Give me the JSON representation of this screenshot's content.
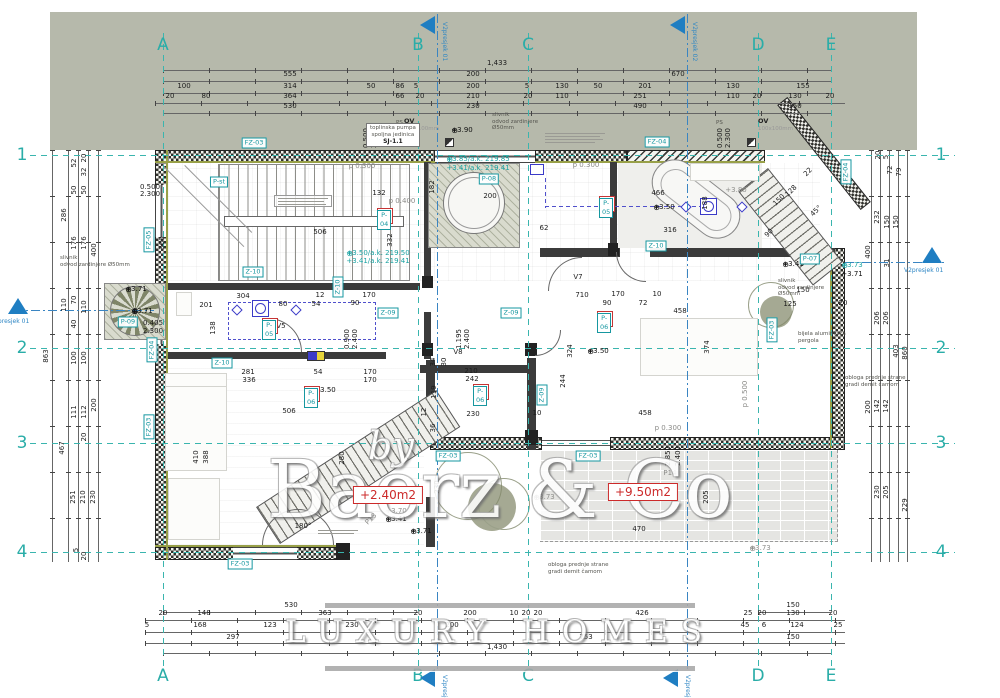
{
  "watermark": {
    "by": "by",
    "name": "Baerz & Co",
    "tagline": "LUXURY HOMES"
  },
  "grid": {
    "cols": [
      {
        "l": "A",
        "x": 163
      },
      {
        "l": "B",
        "x": 418
      },
      {
        "l": "C",
        "x": 528
      },
      {
        "l": "D",
        "x": 758
      },
      {
        "l": "E",
        "x": 831
      }
    ],
    "rows": [
      {
        "l": "1",
        "y": 155
      },
      {
        "l": "2",
        "y": 348
      },
      {
        "l": "3",
        "y": 443
      },
      {
        "l": "4",
        "y": 552
      }
    ]
  },
  "sections": [
    {
      "t": "V2presjek 01",
      "kind": "top",
      "x": 437,
      "y": 16
    },
    {
      "t": "V2presjek 02",
      "kind": "top",
      "x": 687,
      "y": 16
    },
    {
      "t": "V2presjek 01",
      "kind": "bottom",
      "x": 437,
      "y": 669
    },
    {
      "t": "V2presjek 02",
      "kind": "bottom",
      "x": 680,
      "y": 669
    },
    {
      "t": "V2presjek 01",
      "kind": "left",
      "x": 18,
      "y": 298
    },
    {
      "t": "V2presjek 01",
      "kind": "right",
      "x": 932,
      "y": 247
    }
  ],
  "rooms": [
    {
      "n": "1",
      "tag": "P-04",
      "x": 377,
      "y": 208
    },
    {
      "n": "4",
      "tag": "P-05",
      "x": 599,
      "y": 196
    },
    {
      "n": "2",
      "tag": "P-06",
      "x": 597,
      "y": 311
    },
    {
      "n": "3",
      "tag": "P-06",
      "x": 473,
      "y": 384
    },
    {
      "n": "5",
      "tag": "P-06",
      "x": 304,
      "y": 386
    },
    {
      "n": "6",
      "tag": "P-05",
      "x": 262,
      "y": 318
    }
  ],
  "tags": [
    {
      "t": "FZ-03",
      "x": 254,
      "y": 143,
      "o": "h"
    },
    {
      "t": "FZ-04",
      "x": 657,
      "y": 142,
      "o": "h"
    },
    {
      "t": "FZ-04",
      "x": 846,
      "y": 172,
      "o": "v"
    },
    {
      "t": "FZ-05",
      "x": 149,
      "y": 240,
      "o": "v"
    },
    {
      "t": "FZ-04",
      "x": 152,
      "y": 350,
      "o": "v"
    },
    {
      "t": "FZ-03",
      "x": 149,
      "y": 427,
      "o": "v"
    },
    {
      "t": "FZ-03",
      "x": 240,
      "y": 564,
      "o": "h"
    },
    {
      "t": "FZ-03",
      "x": 448,
      "y": 456,
      "o": "h"
    },
    {
      "t": "FZ-03",
      "x": 588,
      "y": 456,
      "o": "h"
    },
    {
      "t": "FZ-03",
      "x": 772,
      "y": 330,
      "o": "v"
    },
    {
      "t": "Z-10",
      "x": 253,
      "y": 272,
      "o": "h"
    },
    {
      "t": "Z-10",
      "x": 656,
      "y": 246,
      "o": "h"
    },
    {
      "t": "Z-10",
      "x": 222,
      "y": 363,
      "o": "h"
    },
    {
      "t": "Z-10",
      "x": 338,
      "y": 287,
      "o": "v"
    },
    {
      "t": "Z-09",
      "x": 388,
      "y": 313,
      "o": "h"
    },
    {
      "t": "Z-09",
      "x": 511,
      "y": 313,
      "o": "h"
    },
    {
      "t": "Z-09",
      "x": 542,
      "y": 395,
      "o": "v"
    },
    {
      "t": "P-st",
      "x": 219,
      "y": 182,
      "o": "h"
    },
    {
      "t": "P-08",
      "x": 489,
      "y": 179,
      "o": "h"
    },
    {
      "t": "P-09",
      "x": 128,
      "y": 322,
      "o": "h"
    },
    {
      "t": "P-07",
      "x": 810,
      "y": 259,
      "o": "h"
    }
  ],
  "red_areas": [
    {
      "t": "+2.40m2",
      "x": 388,
      "y": 495
    },
    {
      "t": "+9.50m2",
      "x": 643,
      "y": 492
    }
  ],
  "levels": [
    {
      "t": "+3.90",
      "x": 462,
      "y": 130,
      "s": "b",
      "star": 1
    },
    {
      "t": "+3.50",
      "x": 664,
      "y": 207,
      "s": "b",
      "star": 1
    },
    {
      "t": "+3.50",
      "x": 598,
      "y": 351,
      "s": "b",
      "star": 1
    },
    {
      "t": "+3.50",
      "x": 325,
      "y": 390,
      "s": "b",
      "star": 1
    },
    {
      "t": "+3.41",
      "x": 793,
      "y": 264,
      "s": "b",
      "star": 1
    },
    {
      "t": "+3.73",
      "x": 852,
      "y": 265,
      "s": "t",
      "star": 1
    },
    {
      "t": "+3.71",
      "x": 852,
      "y": 274,
      "s": "b",
      "star": 0
    },
    {
      "t": "+3.71",
      "x": 136,
      "y": 289,
      "s": "b",
      "star": 1
    },
    {
      "t": "+3.71",
      "x": 142,
      "y": 311,
      "s": "b",
      "star": 1
    },
    {
      "t": "+3.85/a.k. 219.85",
      "x": 478,
      "y": 159,
      "s": "t",
      "star": 1
    },
    {
      "t": "+3.41/a.k. 219.41",
      "x": 478,
      "y": 168,
      "s": "t",
      "star": 0
    },
    {
      "t": "+3.50/a.k. 219.50",
      "x": 378,
      "y": 253,
      "s": "t",
      "star": 1
    },
    {
      "t": "+3.41/a.k. 219.41",
      "x": 378,
      "y": 261,
      "s": "t",
      "star": 0
    },
    {
      "t": "+3.80",
      "x": 736,
      "y": 190,
      "s": "g",
      "star": 0
    },
    {
      "t": "+3.73",
      "x": 544,
      "y": 497,
      "s": "g",
      "star": 1
    },
    {
      "t": "+3.70",
      "x": 396,
      "y": 511,
      "s": "g",
      "star": 0
    },
    {
      "t": "+3.41",
      "x": 396,
      "y": 519,
      "s": "b",
      "star": 1
    },
    {
      "t": "+3.71",
      "x": 421,
      "y": 531,
      "s": "b",
      "star": 1
    },
    {
      "t": "+3.73",
      "x": 760,
      "y": 548,
      "s": "g",
      "star": 1
    }
  ],
  "notes": [
    {
      "lines": [
        "slivnik",
        "odvod zardinjere",
        "Ø50mm"
      ],
      "x": 492,
      "y": 112
    },
    {
      "lines": [
        "slivnik",
        "odvod zardinjere Ø50mm"
      ],
      "x": 60,
      "y": 255
    },
    {
      "lines": [
        "slivnik",
        "odvod zardinjere",
        "Ø50mm"
      ],
      "x": 778,
      "y": 278
    },
    {
      "lines": [
        "OV",
        "100x100mm"
      ],
      "x": 404,
      "y": 118,
      "cls": "ov"
    },
    {
      "lines": [
        "OV",
        "100x100mm"
      ],
      "x": 758,
      "y": 118,
      "cls": "ov"
    },
    {
      "lines": [
        "PS"
      ],
      "x": 396,
      "y": 120
    },
    {
      "lines": [
        "PS"
      ],
      "x": 716,
      "y": 120
    },
    {
      "lines": [
        "bijela aluminijska",
        "pergola"
      ],
      "x": 798,
      "y": 331
    },
    {
      "lines": [
        "obloga prednje strane",
        "gradi demit čamom"
      ],
      "x": 845,
      "y": 375
    },
    {
      "lines": [
        "obloga prednje strane",
        "gradi demit čamom"
      ],
      "x": 548,
      "y": 562
    },
    {
      "lines": [
        "toplinska pumpa",
        "spoljna jedinica"
      ],
      "title": "SJ-1.1",
      "x": 366,
      "y": 123,
      "cls": "box"
    }
  ],
  "dims": [
    {
      "t": "1,433",
      "x": 497,
      "y": 63
    },
    {
      "t": "555",
      "x": 290,
      "y": 74
    },
    {
      "t": "200",
      "x": 473,
      "y": 74
    },
    {
      "t": "670",
      "x": 678,
      "y": 74
    },
    {
      "t": "100",
      "x": 184,
      "y": 86
    },
    {
      "t": "314",
      "x": 290,
      "y": 86
    },
    {
      "t": "50",
      "x": 371,
      "y": 86
    },
    {
      "t": "86",
      "x": 400,
      "y": 86
    },
    {
      "t": "5",
      "x": 416,
      "y": 86
    },
    {
      "t": "200",
      "x": 473,
      "y": 86
    },
    {
      "t": "5",
      "x": 527,
      "y": 86
    },
    {
      "t": "130",
      "x": 562,
      "y": 86
    },
    {
      "t": "50",
      "x": 598,
      "y": 86
    },
    {
      "t": "201",
      "x": 645,
      "y": 86
    },
    {
      "t": "130",
      "x": 733,
      "y": 86
    },
    {
      "t": "155",
      "x": 803,
      "y": 86
    },
    {
      "t": "20",
      "x": 170,
      "y": 96
    },
    {
      "t": "80",
      "x": 206,
      "y": 96
    },
    {
      "t": "364",
      "x": 290,
      "y": 96
    },
    {
      "t": "66",
      "x": 400,
      "y": 96
    },
    {
      "t": "20",
      "x": 420,
      "y": 96
    },
    {
      "t": "210",
      "x": 473,
      "y": 96
    },
    {
      "t": "20",
      "x": 528,
      "y": 96
    },
    {
      "t": "110",
      "x": 562,
      "y": 96
    },
    {
      "t": "251",
      "x": 640,
      "y": 96
    },
    {
      "t": "110",
      "x": 733,
      "y": 96
    },
    {
      "t": "20",
      "x": 757,
      "y": 96
    },
    {
      "t": "130",
      "x": 795,
      "y": 96
    },
    {
      "t": "20",
      "x": 830,
      "y": 96
    },
    {
      "t": "530",
      "x": 290,
      "y": 106
    },
    {
      "t": "230",
      "x": 473,
      "y": 106
    },
    {
      "t": "490",
      "x": 640,
      "y": 106
    },
    {
      "t": "150",
      "x": 795,
      "y": 106
    },
    {
      "t": "530",
      "x": 291,
      "y": 605
    },
    {
      "t": "150",
      "x": 793,
      "y": 605
    },
    {
      "t": "20",
      "x": 163,
      "y": 613
    },
    {
      "t": "148",
      "x": 204,
      "y": 613
    },
    {
      "t": "363",
      "x": 325,
      "y": 613
    },
    {
      "t": "20",
      "x": 418,
      "y": 613
    },
    {
      "t": "200",
      "x": 470,
      "y": 613
    },
    {
      "t": "10",
      "x": 514,
      "y": 613
    },
    {
      "t": "20",
      "x": 526,
      "y": 613
    },
    {
      "t": "20",
      "x": 538,
      "y": 613
    },
    {
      "t": "426",
      "x": 642,
      "y": 613
    },
    {
      "t": "25",
      "x": 748,
      "y": 613
    },
    {
      "t": "20",
      "x": 762,
      "y": 613
    },
    {
      "t": "130",
      "x": 793,
      "y": 613
    },
    {
      "t": "20",
      "x": 833,
      "y": 613
    },
    {
      "t": "5",
      "x": 147,
      "y": 625
    },
    {
      "t": "168",
      "x": 200,
      "y": 625
    },
    {
      "t": "123",
      "x": 270,
      "y": 625
    },
    {
      "t": "230",
      "x": 352,
      "y": 625
    },
    {
      "t": "200",
      "x": 452,
      "y": 625
    },
    {
      "t": "45",
      "x": 745,
      "y": 625
    },
    {
      "t": "6",
      "x": 764,
      "y": 625
    },
    {
      "t": "124",
      "x": 797,
      "y": 625
    },
    {
      "t": "25",
      "x": 838,
      "y": 625
    },
    {
      "t": "297",
      "x": 233,
      "y": 637
    },
    {
      "t": "753",
      "x": 586,
      "y": 637
    },
    {
      "t": "150",
      "x": 793,
      "y": 637
    },
    {
      "t": "1,430",
      "x": 497,
      "y": 647
    },
    {
      "t": "52",
      "x": 74,
      "y": 163,
      "r": 1
    },
    {
      "t": "20",
      "x": 84,
      "y": 158,
      "r": 1
    },
    {
      "t": "32",
      "x": 84,
      "y": 172,
      "r": 1
    },
    {
      "t": "50",
      "x": 74,
      "y": 190,
      "r": 1
    },
    {
      "t": "50",
      "x": 84,
      "y": 190,
      "r": 1
    },
    {
      "t": "286",
      "x": 64,
      "y": 215,
      "r": 1
    },
    {
      "t": "176",
      "x": 74,
      "y": 243,
      "r": 1
    },
    {
      "t": "176",
      "x": 84,
      "y": 243,
      "r": 1
    },
    {
      "t": "400",
      "x": 94,
      "y": 250,
      "r": 1
    },
    {
      "t": "110",
      "x": 64,
      "y": 305,
      "r": 1
    },
    {
      "t": "70",
      "x": 74,
      "y": 300,
      "r": 1
    },
    {
      "t": "110",
      "x": 84,
      "y": 307,
      "r": 1
    },
    {
      "t": "40",
      "x": 74,
      "y": 324,
      "r": 1
    },
    {
      "t": "863",
      "x": 46,
      "y": 356,
      "r": 1
    },
    {
      "t": "100",
      "x": 74,
      "y": 358,
      "r": 1
    },
    {
      "t": "100",
      "x": 84,
      "y": 358,
      "r": 1
    },
    {
      "t": "111",
      "x": 74,
      "y": 412,
      "r": 1
    },
    {
      "t": "112",
      "x": 84,
      "y": 412,
      "r": 1
    },
    {
      "t": "200",
      "x": 94,
      "y": 405,
      "r": 1
    },
    {
      "t": "467",
      "x": 62,
      "y": 448,
      "r": 1
    },
    {
      "t": "20",
      "x": 84,
      "y": 437,
      "r": 1
    },
    {
      "t": "251",
      "x": 73,
      "y": 497,
      "r": 1
    },
    {
      "t": "210",
      "x": 83,
      "y": 497,
      "r": 1
    },
    {
      "t": "230",
      "x": 93,
      "y": 497,
      "r": 1
    },
    {
      "t": "5",
      "x": 76,
      "y": 550,
      "r": 1
    },
    {
      "t": "20",
      "x": 84,
      "y": 556,
      "r": 1
    },
    {
      "t": "20",
      "x": 878,
      "y": 155,
      "r": 1
    },
    {
      "t": "5",
      "x": 886,
      "y": 157,
      "r": 1
    },
    {
      "t": "72",
      "x": 890,
      "y": 170,
      "r": 1
    },
    {
      "t": "79",
      "x": 899,
      "y": 172,
      "r": 1
    },
    {
      "t": "232",
      "x": 877,
      "y": 217,
      "r": 1
    },
    {
      "t": "150",
      "x": 887,
      "y": 222,
      "r": 1
    },
    {
      "t": "150",
      "x": 896,
      "y": 222,
      "r": 1
    },
    {
      "t": "400",
      "x": 868,
      "y": 252,
      "r": 1
    },
    {
      "t": "31",
      "x": 887,
      "y": 263,
      "r": 1
    },
    {
      "t": "206",
      "x": 877,
      "y": 318,
      "r": 1
    },
    {
      "t": "206",
      "x": 886,
      "y": 318,
      "r": 1
    },
    {
      "t": "403",
      "x": 896,
      "y": 351,
      "r": 1
    },
    {
      "t": "860",
      "x": 905,
      "y": 353,
      "r": 1
    },
    {
      "t": "200",
      "x": 868,
      "y": 407,
      "r": 1
    },
    {
      "t": "142",
      "x": 877,
      "y": 406,
      "r": 1
    },
    {
      "t": "142",
      "x": 886,
      "y": 406,
      "r": 1
    },
    {
      "t": "230",
      "x": 877,
      "y": 492,
      "r": 1
    },
    {
      "t": "205",
      "x": 886,
      "y": 492,
      "r": 1
    },
    {
      "t": "229",
      "x": 905,
      "y": 505,
      "r": 1
    },
    {
      "t": "132",
      "x": 379,
      "y": 193
    },
    {
      "t": "506",
      "x": 320,
      "y": 232
    },
    {
      "t": "360",
      "x": 162,
      "y": 243,
      "r": 1
    },
    {
      "t": "332",
      "x": 390,
      "y": 240,
      "r": 1
    },
    {
      "t": "182",
      "x": 432,
      "y": 187,
      "r": 1
    },
    {
      "t": "200",
      "x": 490,
      "y": 196
    },
    {
      "t": "466",
      "x": 658,
      "y": 193
    },
    {
      "t": "62",
      "x": 544,
      "y": 228
    },
    {
      "t": "316",
      "x": 670,
      "y": 230
    },
    {
      "t": "188",
      "x": 705,
      "y": 203,
      "r": 1
    },
    {
      "t": "710",
      "x": 582,
      "y": 295
    },
    {
      "t": "170",
      "x": 618,
      "y": 294
    },
    {
      "t": "10",
      "x": 657,
      "y": 294
    },
    {
      "t": "90",
      "x": 607,
      "y": 303
    },
    {
      "t": "72",
      "x": 643,
      "y": 303
    },
    {
      "t": "458",
      "x": 680,
      "y": 311
    },
    {
      "t": "150",
      "x": 779,
      "y": 200,
      "r": 2
    },
    {
      "t": "128",
      "x": 791,
      "y": 191,
      "r": 2
    },
    {
      "t": "22",
      "x": 808,
      "y": 172,
      "r": 2
    },
    {
      "t": "90",
      "x": 769,
      "y": 233,
      "r": 2
    },
    {
      "t": "45°",
      "x": 816,
      "y": 211,
      "r": 2
    },
    {
      "t": "281",
      "x": 248,
      "y": 372
    },
    {
      "t": "336",
      "x": 249,
      "y": 380
    },
    {
      "t": "54",
      "x": 318,
      "y": 372
    },
    {
      "t": "170",
      "x": 370,
      "y": 372
    },
    {
      "t": "170",
      "x": 370,
      "y": 380
    },
    {
      "t": "506",
      "x": 289,
      "y": 411
    },
    {
      "t": "410",
      "x": 196,
      "y": 457,
      "r": 1
    },
    {
      "t": "388",
      "x": 206,
      "y": 457,
      "r": 1
    },
    {
      "t": "280",
      "x": 342,
      "y": 458,
      "r": 1
    },
    {
      "t": "210",
      "x": 471,
      "y": 371
    },
    {
      "t": "242",
      "x": 472,
      "y": 379
    },
    {
      "t": "230",
      "x": 473,
      "y": 414
    },
    {
      "t": "119",
      "x": 434,
      "y": 392,
      "r": 1
    },
    {
      "t": "12",
      "x": 424,
      "y": 412,
      "r": 1
    },
    {
      "t": "36",
      "x": 433,
      "y": 428,
      "r": 1
    },
    {
      "t": "34",
      "x": 433,
      "y": 362,
      "r": 1
    },
    {
      "t": "30",
      "x": 444,
      "y": 362,
      "r": 1
    },
    {
      "t": "324",
      "x": 570,
      "y": 351,
      "r": 1
    },
    {
      "t": "244",
      "x": 563,
      "y": 381,
      "r": 1
    },
    {
      "t": "458",
      "x": 645,
      "y": 413
    },
    {
      "t": "10",
      "x": 537,
      "y": 413
    },
    {
      "t": "470",
      "x": 639,
      "y": 529
    },
    {
      "t": "205",
      "x": 706,
      "y": 497,
      "r": 1
    },
    {
      "t": "230",
      "x": 437,
      "y": 487,
      "r": 1
    },
    {
      "t": "150",
      "x": 803,
      "y": 290
    },
    {
      "t": "125",
      "x": 790,
      "y": 304
    },
    {
      "t": "20",
      "x": 843,
      "y": 303
    },
    {
      "t": "374",
      "x": 707,
      "y": 347,
      "r": 1
    },
    {
      "t": "304",
      "x": 243,
      "y": 296
    },
    {
      "t": "201",
      "x": 206,
      "y": 305
    },
    {
      "t": "138",
      "x": 213,
      "y": 328,
      "r": 1
    },
    {
      "t": "12",
      "x": 320,
      "y": 295
    },
    {
      "t": "80",
      "x": 283,
      "y": 304
    },
    {
      "t": "54",
      "x": 316,
      "y": 304
    },
    {
      "t": "90",
      "x": 355,
      "y": 303
    },
    {
      "t": "170",
      "x": 369,
      "y": 295
    },
    {
      "t": "0.500",
      "x": 366,
      "y": 138,
      "r": 1
    },
    {
      "t": "2.300",
      "x": 374,
      "y": 138,
      "r": 1
    },
    {
      "t": "0.500",
      "x": 720,
      "y": 138,
      "r": 1
    },
    {
      "t": "2.300",
      "x": 728,
      "y": 138,
      "r": 1
    },
    {
      "t": "0.500",
      "x": 150,
      "y": 187
    },
    {
      "t": "2.300",
      "x": 150,
      "y": 194
    },
    {
      "t": "0.405",
      "x": 153,
      "y": 323
    },
    {
      "t": "2.300",
      "x": 153,
      "y": 331
    },
    {
      "t": "1.195",
      "x": 459,
      "y": 339,
      "r": 1
    },
    {
      "t": "2.400",
      "x": 467,
      "y": 339,
      "r": 1
    },
    {
      "t": "0.900",
      "x": 347,
      "y": 339,
      "r": 1
    },
    {
      "t": "2.400",
      "x": 355,
      "y": 339,
      "r": 1
    },
    {
      "t": "2.850",
      "x": 668,
      "y": 456,
      "r": 1
    },
    {
      "t": "2.400",
      "x": 678,
      "y": 456,
      "r": 1
    },
    {
      "t": "p 0.300",
      "x": 362,
      "y": 166,
      "g": 1
    },
    {
      "t": "p 0.300",
      "x": 586,
      "y": 165,
      "g": 1
    },
    {
      "t": "p 0.300",
      "x": 668,
      "y": 428,
      "g": 1
    },
    {
      "t": "p 0.400",
      "x": 402,
      "y": 201,
      "g": 1
    },
    {
      "t": "p 0.500",
      "x": 745,
      "y": 394,
      "r": 1,
      "g": 1
    },
    {
      "t": "P14",
      "x": 670,
      "y": 473,
      "g": 1
    },
    {
      "t": "V8",
      "x": 458,
      "y": 352
    },
    {
      "t": "V5",
      "x": 281,
      "y": 326
    },
    {
      "t": "V7",
      "x": 578,
      "y": 277
    },
    {
      "t": "180°",
      "x": 303,
      "y": 526
    },
    {
      "t": "P13",
      "x": 371,
      "y": 519,
      "r": 2,
      "g": 1
    }
  ]
}
